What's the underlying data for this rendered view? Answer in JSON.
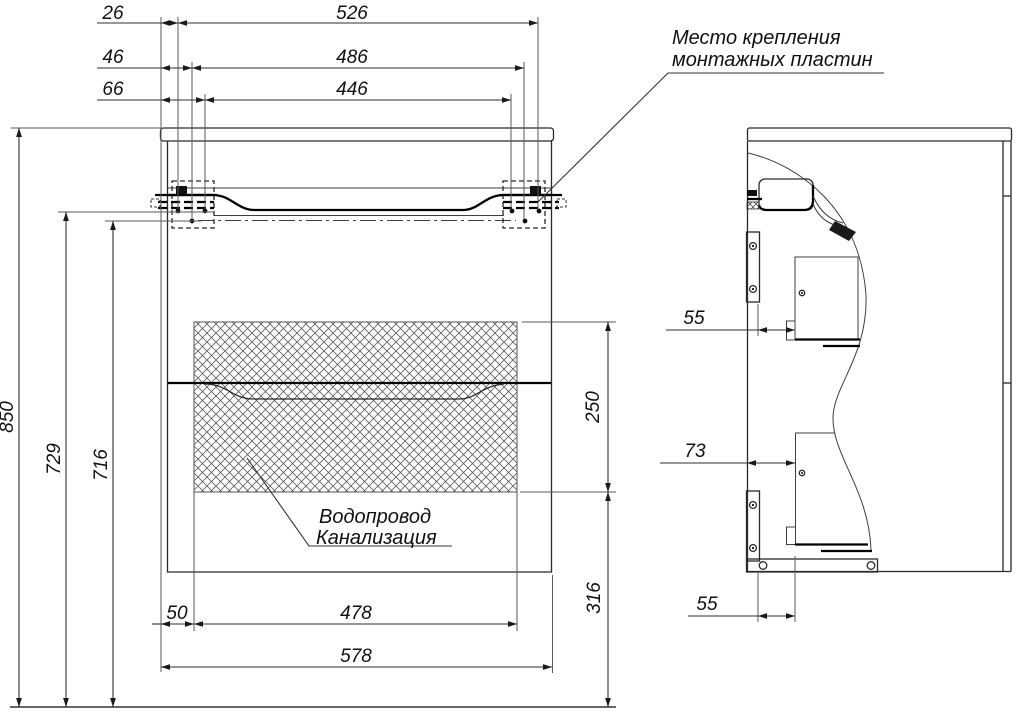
{
  "colors": {
    "line": "#222222",
    "dim_text": "#111111",
    "background": "#ffffff"
  },
  "annotations": {
    "mounting_note": {
      "line1": "Место крепления",
      "line2": "монтажных пластин"
    },
    "plumbing_note": {
      "line1": "Водопровод",
      "line2": "Канализация"
    }
  },
  "front_view": {
    "top_dims": {
      "offset_1": "26",
      "span_1": "526",
      "offset_2": "46",
      "span_2": "486",
      "offset_3": "66",
      "span_3": "446"
    },
    "left_dims": {
      "overall_height": "850",
      "mount_height": "729",
      "body_top_height": "716"
    },
    "right_dims": {
      "service_zone_height": "250",
      "under_zone_height": "316"
    },
    "bottom_dims": {
      "side_offset": "50",
      "service_zone_width": "478",
      "overall_width": "578"
    }
  },
  "side_view": {
    "dims": {
      "upper_drawer_clearance": "55",
      "lower_drawer_clearance": "73",
      "plinth_clearance": "55"
    }
  }
}
